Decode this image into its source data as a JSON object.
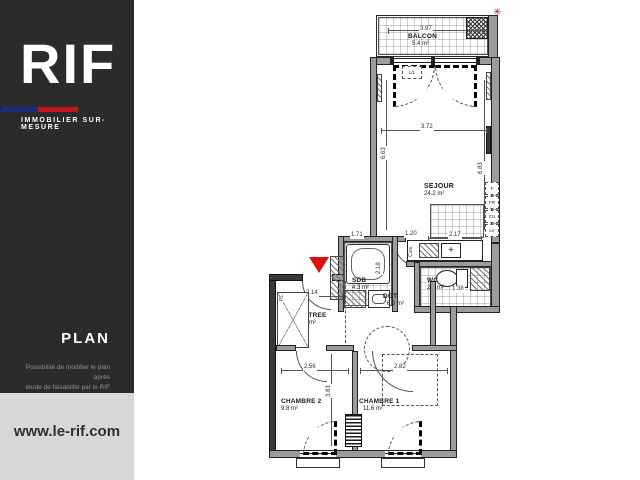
{
  "sidebar": {
    "logo_text": "RIF",
    "tagline": "IMMOBILIER SUR-MESURE",
    "section_title": "PLAN",
    "note_line1": "Possibilité de modifier le plan après",
    "note_line2": "étude de faisabilité par le RIF",
    "website": "www.le-rif.com"
  },
  "plan": {
    "north_mark": "✳",
    "rooms": {
      "balcon": {
        "name": "BALCON",
        "area": "5.4 m²"
      },
      "sejour": {
        "name": "SEJOUR",
        "area": "24.2 m²"
      },
      "sdb": {
        "name": "SDB",
        "area": "4.3 m²"
      },
      "wc": {
        "name": "WC",
        "area": "2.8 m²"
      },
      "entree": {
        "name": "ENTREE",
        "area": "4.5 m²"
      },
      "dgt": {
        "name": "DGT",
        "area": "6.3 m²"
      },
      "chambre2": {
        "name": "CHAMBRE 2",
        "area": "9.8 m²"
      },
      "chambre1": {
        "name": "CHAMBRE 1",
        "area": "11.6 m²"
      }
    },
    "dims": {
      "balcony_width": "3.97",
      "sejour_width": "3.72",
      "sejour_height_left": "6.63",
      "sejour_height_right": "6.83",
      "sdb_width": "1.71",
      "hall_width": "1.20",
      "kitchen_width": "2.17",
      "sdb_depth": "2.18",
      "entree_width": "2.14",
      "wc_width": "1.38",
      "chambre2_width": "2.56",
      "chambre1_width": "2.82",
      "chambres_depth": "3.83"
    },
    "appliances": [
      "F",
      "FR",
      "CU",
      "LV"
    ],
    "labels": {
      "closet": "PL",
      "washer": "L/L",
      "counter": "Cuis.",
      "sink_cross": "+"
    }
  },
  "colors": {
    "sidebar_background": "#2b2b2b",
    "footer_background": "#d8d8d8",
    "flag_blue": "#1b2a7b",
    "flag_red": "#c3161c",
    "accent_red": "#dd1111",
    "wall_gray": "#9c9c9c"
  }
}
